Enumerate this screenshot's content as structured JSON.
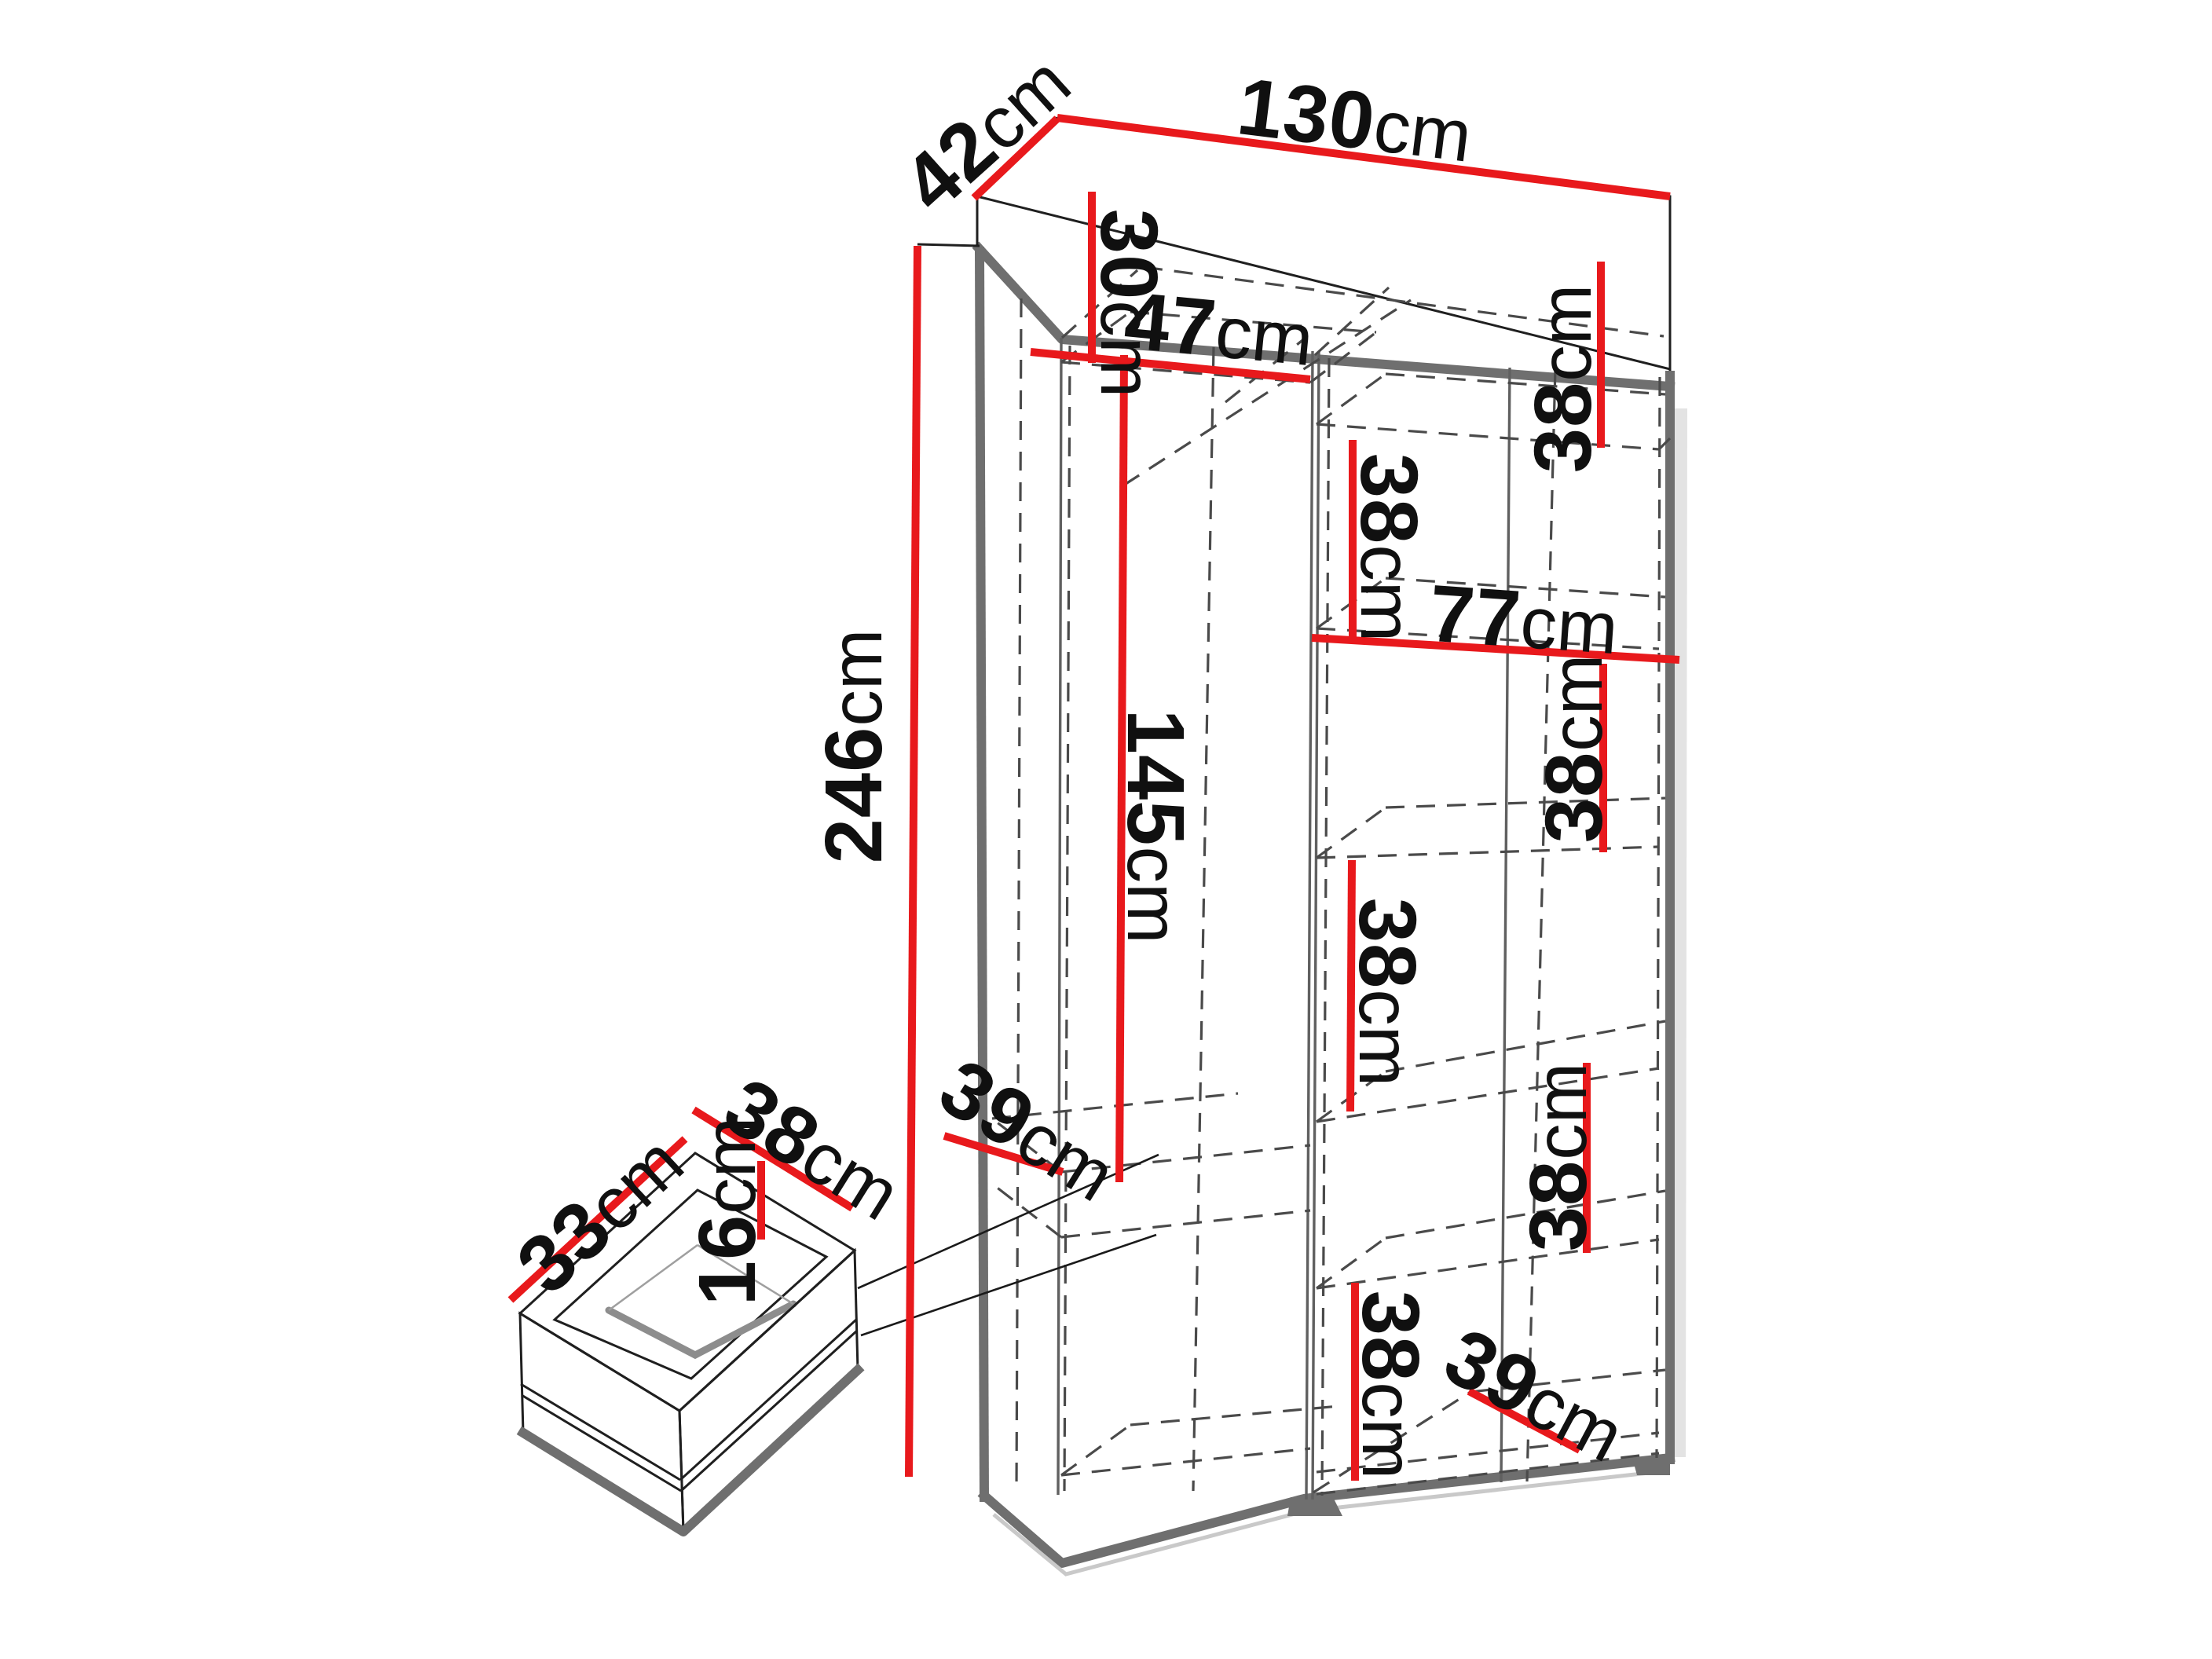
{
  "colors": {
    "dimension_accent": "#e8191c",
    "outline_gray": "#6f6f6f",
    "dash_gray": "#4a4a4a",
    "text": "#101010"
  },
  "wardrobe": {
    "width": {
      "value": "130",
      "unit": "cm"
    },
    "depth": {
      "value": "42",
      "unit": "cm"
    },
    "height": {
      "value": "246",
      "unit": "cm"
    },
    "left_column": {
      "top_shelf_height": {
        "value": "30",
        "unit": "cm"
      },
      "width": {
        "value": "47",
        "unit": "cm"
      },
      "hanging_height": {
        "value": "145",
        "unit": "cm"
      },
      "bottom_shelf_depth": {
        "value": "39",
        "unit": "cm"
      }
    },
    "right_column": {
      "width": {
        "value": "77",
        "unit": "cm"
      },
      "sections": [
        {
          "value": "38",
          "unit": "cm"
        },
        {
          "value": "38",
          "unit": "cm"
        },
        {
          "value": "38",
          "unit": "cm"
        },
        {
          "value": "38",
          "unit": "cm"
        },
        {
          "value": "38",
          "unit": "cm"
        },
        {
          "value": "38",
          "unit": "cm"
        }
      ],
      "bottom_shelf_depth": {
        "value": "39",
        "unit": "cm"
      }
    }
  },
  "drawer": {
    "depth": {
      "value": "33",
      "unit": "cm"
    },
    "width": {
      "value": "38",
      "unit": "cm"
    },
    "height": {
      "value": "16",
      "unit": "cm"
    }
  }
}
